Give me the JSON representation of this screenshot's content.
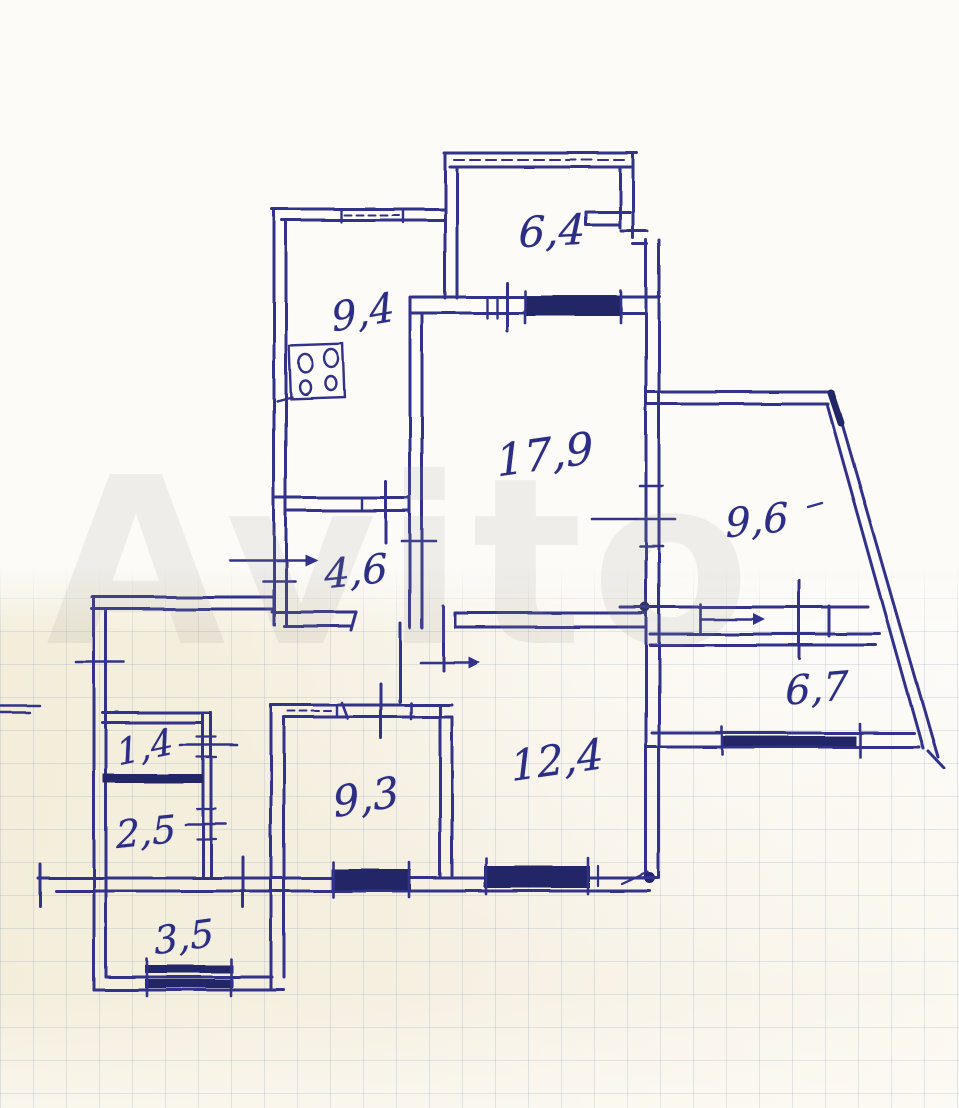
{
  "page": {
    "kind": "hand-drawn apartment floor plan sketch on graph paper",
    "watermark_text": "Avito",
    "ink_color": "#31338a",
    "ink_dark_color": "#232566",
    "paper_tint": "#f4eedd",
    "grid_cell_px": 33
  },
  "floorplan": {
    "rooms": [
      {
        "id": "balcony",
        "label": "6,4"
      },
      {
        "id": "kitchen",
        "label": "9,4"
      },
      {
        "id": "living-room",
        "label": "17,9"
      },
      {
        "id": "room-upper-right",
        "label": "9,6"
      },
      {
        "id": "hallway",
        "label": "4,6"
      },
      {
        "id": "room-lower-right",
        "label": "6,7"
      },
      {
        "id": "corridor",
        "label": "12,4"
      },
      {
        "id": "wc",
        "label": "1,4"
      },
      {
        "id": "bathroom",
        "label": "2,5"
      },
      {
        "id": "room-lower-middle",
        "label": "9,3"
      },
      {
        "id": "storeroom",
        "label": "3,5"
      }
    ]
  }
}
